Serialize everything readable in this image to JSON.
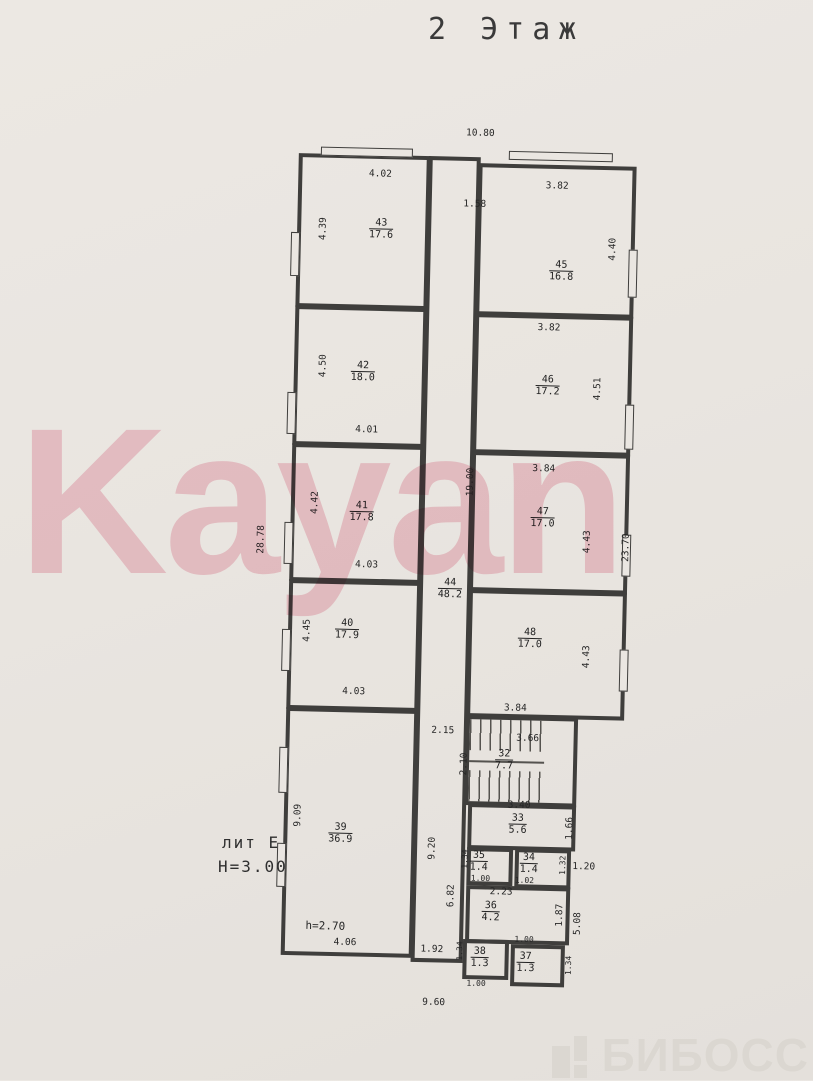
{
  "page": {
    "title": "2 Этаж",
    "watermark": "Kayan",
    "brand": "БИБОСС"
  },
  "annotations": {
    "lit": "лит Е",
    "building_height": "Н=3.00",
    "room39_height": "h=2.70"
  },
  "rooms": {
    "r43": {
      "num": "43",
      "area": "17.6"
    },
    "r42": {
      "num": "42",
      "area": "18.0"
    },
    "r41": {
      "num": "41",
      "area": "17.8"
    },
    "r40": {
      "num": "40",
      "area": "17.9"
    },
    "r39": {
      "num": "39",
      "area": "36.9"
    },
    "r44": {
      "num": "44",
      "area": "48.2"
    },
    "r45": {
      "num": "45",
      "area": "16.8"
    },
    "r46": {
      "num": "46",
      "area": "17.2"
    },
    "r47": {
      "num": "47",
      "area": "17.0"
    },
    "r48": {
      "num": "48",
      "area": "17.0"
    },
    "r32": {
      "num": "32",
      "area": "7.7"
    },
    "r33": {
      "num": "33",
      "area": "5.6"
    },
    "r34": {
      "num": "34",
      "area": "1.4"
    },
    "r35": {
      "num": "35",
      "area": "1.4"
    },
    "r36": {
      "num": "36",
      "area": "4.2"
    },
    "r37": {
      "num": "37",
      "area": "1.3"
    },
    "r38": {
      "num": "38",
      "area": "1.3"
    }
  },
  "dims": {
    "top_overall": "10.80",
    "top_gap": "1.58",
    "bottom_overall": "9.60",
    "left_overall": "28.78",
    "right_overall": "23.70",
    "corridor_v": "19.00",
    "corridor_lower_v": "9.20",
    "corridor_bottom": "1.92",
    "r43_top": "4.02",
    "r43_left": "4.39",
    "r42_left": "4.50",
    "r42_bottom": "4.01",
    "r41_left": "4.42",
    "r41_bottom": "4.03",
    "r40_left": "4.45",
    "r40_bottom": "4.03",
    "r39_left": "9.09",
    "r39_bottom": "4.06",
    "r45_top": "3.82",
    "r45_right": "4.40",
    "r46_top": "3.82",
    "r46_right": "4.51",
    "r47_top": "3.84",
    "r47_right": "4.43",
    "r48_right": "4.43",
    "r48_bottom": "3.84",
    "stairs_gap": "2.15",
    "stairs_top": "3.66",
    "stairs_left": "2.10",
    "r33_top": "3.40",
    "r33_right": "1.66",
    "r35_left": "1.34",
    "r35_bottom": "1.00",
    "r34_right": "1.32",
    "r34_bottom": "1.02",
    "step_right": "1.20",
    "lower_left_v": "6.82",
    "r36_top": "2.23",
    "r36_right": "1.87",
    "lower_right_v": "5.08",
    "r38_left": "1.34",
    "r38_bottom": "1.00",
    "r37_top": "1.00",
    "r37_right": "1.34"
  }
}
